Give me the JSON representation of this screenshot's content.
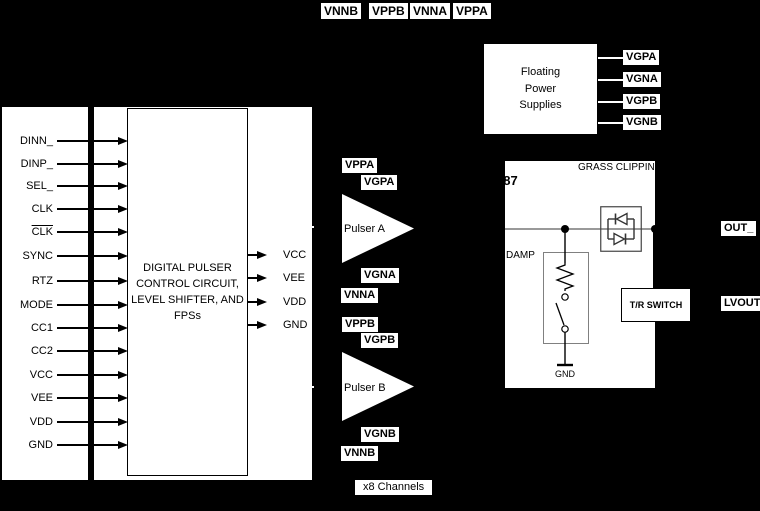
{
  "d": {
    "top_ports": [
      "VNNB",
      "VPPB",
      "VNNA",
      "VPPA"
    ],
    "inputs": [
      "DINN_",
      "DINP_",
      "SEL_",
      "CLK",
      "CLK",
      "SYNC",
      "RTZ",
      "MODE",
      "CC1",
      "CC2",
      "VCC",
      "VEE",
      "VDD",
      "GND"
    ],
    "control_block_title": "DIGITAL PULSER\nCONTROL CIRCUIT,\nLEVEL SHIFTER, AND\nFPSs",
    "supply_outputs": [
      "VCC",
      "VEE",
      "VDD",
      "GND"
    ],
    "pulser_a": {
      "name": "Pulser A",
      "vpp": "VPPA",
      "vgp": "VGPA",
      "vgn": "VGNA",
      "vnn": "VNNA"
    },
    "pulser_b": {
      "name": "Pulser B",
      "vpp": "VPPB",
      "vgp": "VGPB",
      "vgn": "VGNB",
      "vnn": "VNNB"
    },
    "fps": {
      "title": "Floating\nPower\nSupplies",
      "ports": [
        "VGPA",
        "VGNA",
        "VGPB",
        "VGNB"
      ]
    },
    "out_stage": {
      "part": "087",
      "grass": "GRASS\nCLIPPING\nDIODES",
      "damp": "DAMP",
      "gnd": "GND",
      "tr_switch": "T/R SWITCH"
    },
    "ports_right": {
      "out": "OUT_",
      "lvout": "LVOUT_"
    },
    "channels": "x8 Channels",
    "colors": {
      "background": "#000000",
      "panel": "#ffffff",
      "ink": "#000000",
      "wire": "#999999"
    }
  }
}
